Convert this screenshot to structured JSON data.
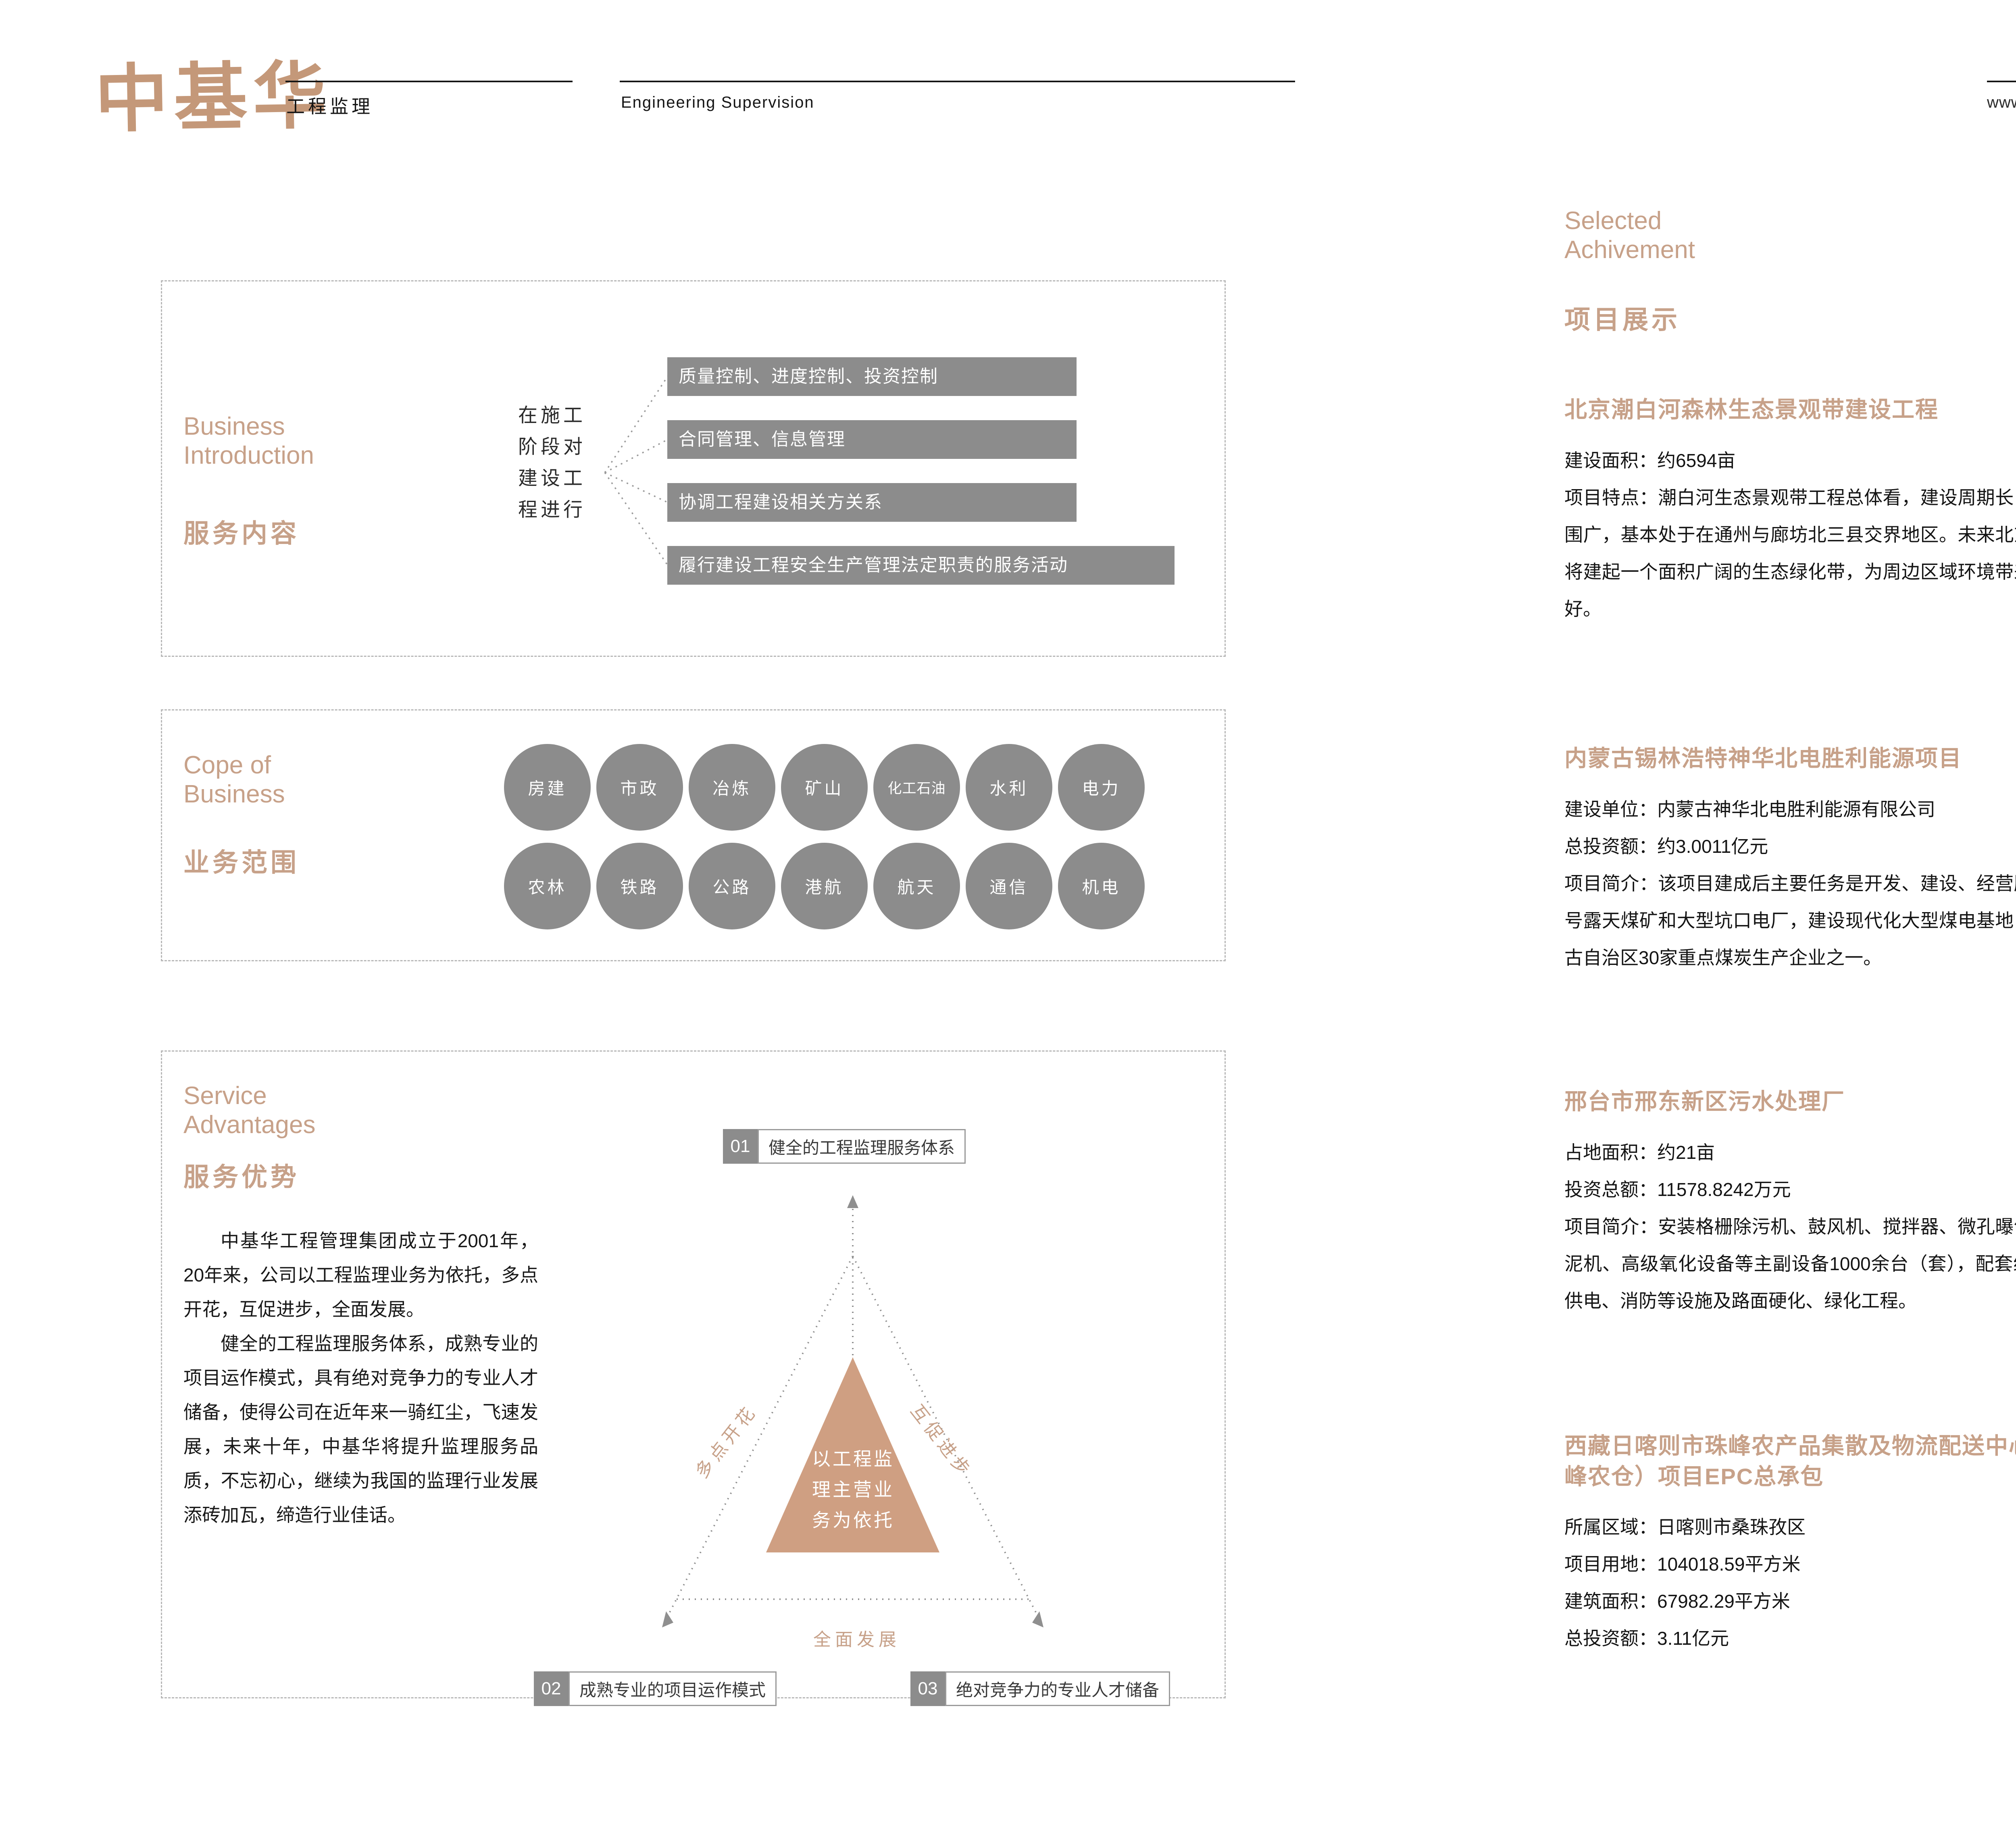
{
  "colors": {
    "accent_tan": "#C7A189",
    "logo_tan": "#C49879",
    "box_gray": "#8C8C8C",
    "badge_light_blue": "#9DC3E6",
    "badge_dark_blue": "#2E74B5",
    "ink": "#1F1F1F"
  },
  "header": {
    "logo": "中基华",
    "logo_caption": "工程监理",
    "tagline_en": "Engineering Supervision",
    "website": "www.zhongjihua.com.cn",
    "page_current": "27",
    "page_total": "28"
  },
  "left_page": {
    "business_intro": {
      "title_en": "Business Introduction",
      "title_cn": "服务内容",
      "stem": "在施工阶段对建设工程进行",
      "boxes": [
        "质量控制、进度控制、投资控制",
        "合同管理、信息管理",
        "协调工程建设相关方关系",
        "履行建设工程安全生产管理法定职责的服务活动"
      ]
    },
    "scope": {
      "title_en": "Cope of Business",
      "title_cn": "业务范围",
      "rows": [
        [
          "房建",
          "市政",
          "冶炼",
          "矿山",
          "化工石油",
          "水利",
          "电力"
        ],
        [
          "农林",
          "铁路",
          "公路",
          "港航",
          "航天",
          "通信",
          "机电"
        ]
      ]
    },
    "service": {
      "title_en": "Service Advantages",
      "title_cn": "服务优势",
      "para1": "中基华工程管理集团成立于2001年，20年来，公司以工程监理业务为依托，多点开花，互促进步，全面发展。",
      "para2": "健全的工程监理服务体系，成熟专业的项目运作模式，具有绝对竞争力的专业人才储备，使得公司在近年来一骑红尘，飞速发展，未来十年，中基华将提升监理服务品质，不忘初心，继续为我国的监理行业发展添砖加瓦，缔造行业佳话。",
      "diagram": {
        "num1": "01",
        "label1": "健全的工程监理服务体系",
        "num2": "02",
        "label2": "成熟专业的项目运作模式",
        "num3": "03",
        "label3": "绝对竞争力的专业人才储备",
        "center": "以工程监理主营业务为依托",
        "edge_left": "多点开花",
        "edge_right": "互促进步",
        "edge_bottom": "全面发展"
      }
    }
  },
  "right_page": {
    "title_en": "Selected Achivement",
    "title_cn": "项目展示",
    "projects": [
      {
        "title": "北京潮白河森林生态景观带建设工程",
        "lines": [
          "建设面积：约6594亩",
          "项目特点：潮白河生态景观带工程总体看，建设周期长，辐射范围广，基本处于在通州与廊坊北三县交界地区。未来北京东部，将建起一个面积广阔的生态绿化带，为周边区域环境带来极大利好。"
        ],
        "photo": "riverside-landscape"
      },
      {
        "title": "内蒙古锡林浩特神华北电胜利能源项目",
        "lines": [
          "建设单位：内蒙古神华北电胜利能源有限公司",
          "总投资额：约3.0011亿元",
          "项目简介：该项目建成后主要任务是开发、建设、经营胜利西一号露天煤矿和大型坑口电厂，建设现代化大型煤电基地，为内蒙古自治区30家重点煤炭生产企业之一。"
        ],
        "photo": "office-campus-rendering"
      },
      {
        "title": "邢台市邢东新区污水处理厂",
        "lines": [
          "占地面积：约21亩",
          "投资总额：11578.8242万元",
          "项目简介：安装格栅除污机、鼓风机、搅拌器、微孔曝气器、刮泥机、高级氧化设备等主副设备1000余台（套），配套给排水、供电、消防等设施及路面硬化、绿化工程。"
        ],
        "photo": "sewage-plant-aerial"
      },
      {
        "title": "西藏日喀则市珠峰农产品集散及物流配送中心（珠峰农仓）项目EPC总承包",
        "lines": [
          "所属区域：日喀则市桑珠孜区",
          "项目用地：104018.59平方米",
          "建筑面积：67982.29平方米",
          "总投资额：3.11亿元"
        ],
        "photo": "logistics-center-rendering"
      }
    ]
  }
}
